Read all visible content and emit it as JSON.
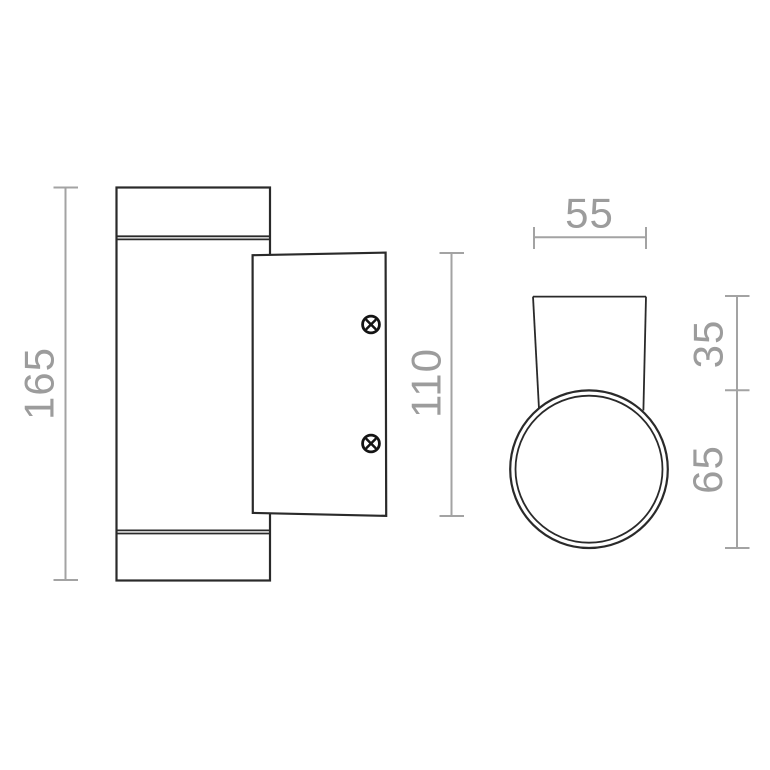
{
  "meta": {
    "background_color": "#ffffff",
    "drawing_line_color": "#2a2a2a",
    "dimension_color": "#9c9c9c",
    "description": "technical dimension drawing, two views of a cylindrical wall lamp"
  },
  "dimensions": {
    "overall_height": "165",
    "plate_height": "110",
    "top_width": "55",
    "bracket_depth": "35",
    "body_diameter": "65"
  },
  "icons": {
    "screw": "phillips-screw-icon"
  },
  "views": {
    "side_view": {
      "parts": [
        "lamp-body",
        "top-cap-seam",
        "bottom-cap-seam",
        "mounting-plate",
        "screws"
      ],
      "screw_count": 2,
      "dimension_labels": [
        "165",
        "110"
      ]
    },
    "top_view": {
      "parts": [
        "mounting-bracket",
        "body-circle-outer",
        "body-circle-inner"
      ],
      "dimension_labels": [
        "55",
        "35",
        "65"
      ]
    }
  }
}
